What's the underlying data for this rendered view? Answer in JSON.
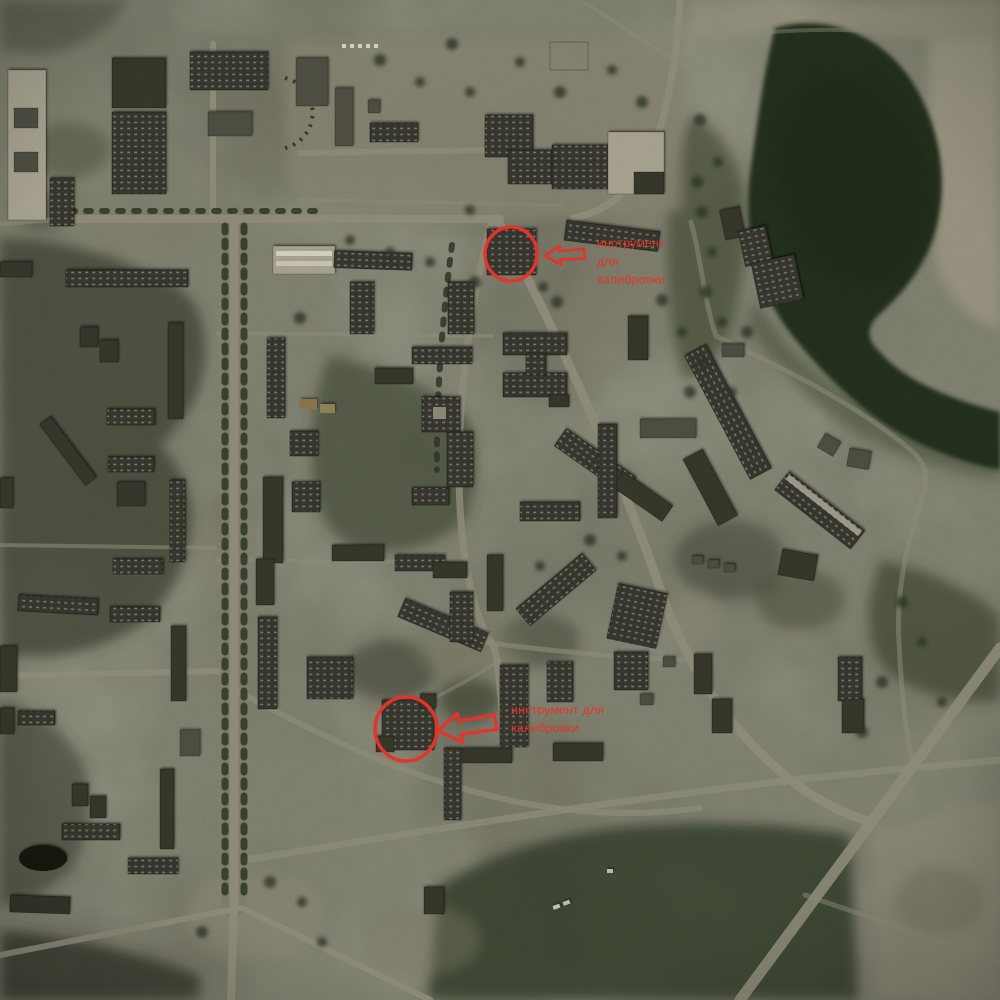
{
  "map": {
    "kind": "satellite-aerial-photo",
    "annotations": {
      "color": "#e2342a",
      "items": [
        {
          "name": "calibration-tool-marker-1",
          "lines": [
            "инструмент",
            "для",
            "калибровки"
          ]
        },
        {
          "name": "calibration-tool-marker-2",
          "lines": [
            "инструмент для",
            "калибровки"
          ]
        }
      ]
    }
  },
  "palette": {
    "terrain": "#6a6859",
    "forest": "#3a4230",
    "water": "#232d1e",
    "road": "#8f8c7a",
    "plaza": "#868371",
    "building-dark": "#34342c",
    "building-light": "#a8a391",
    "shore-light": "#a09a85"
  }
}
